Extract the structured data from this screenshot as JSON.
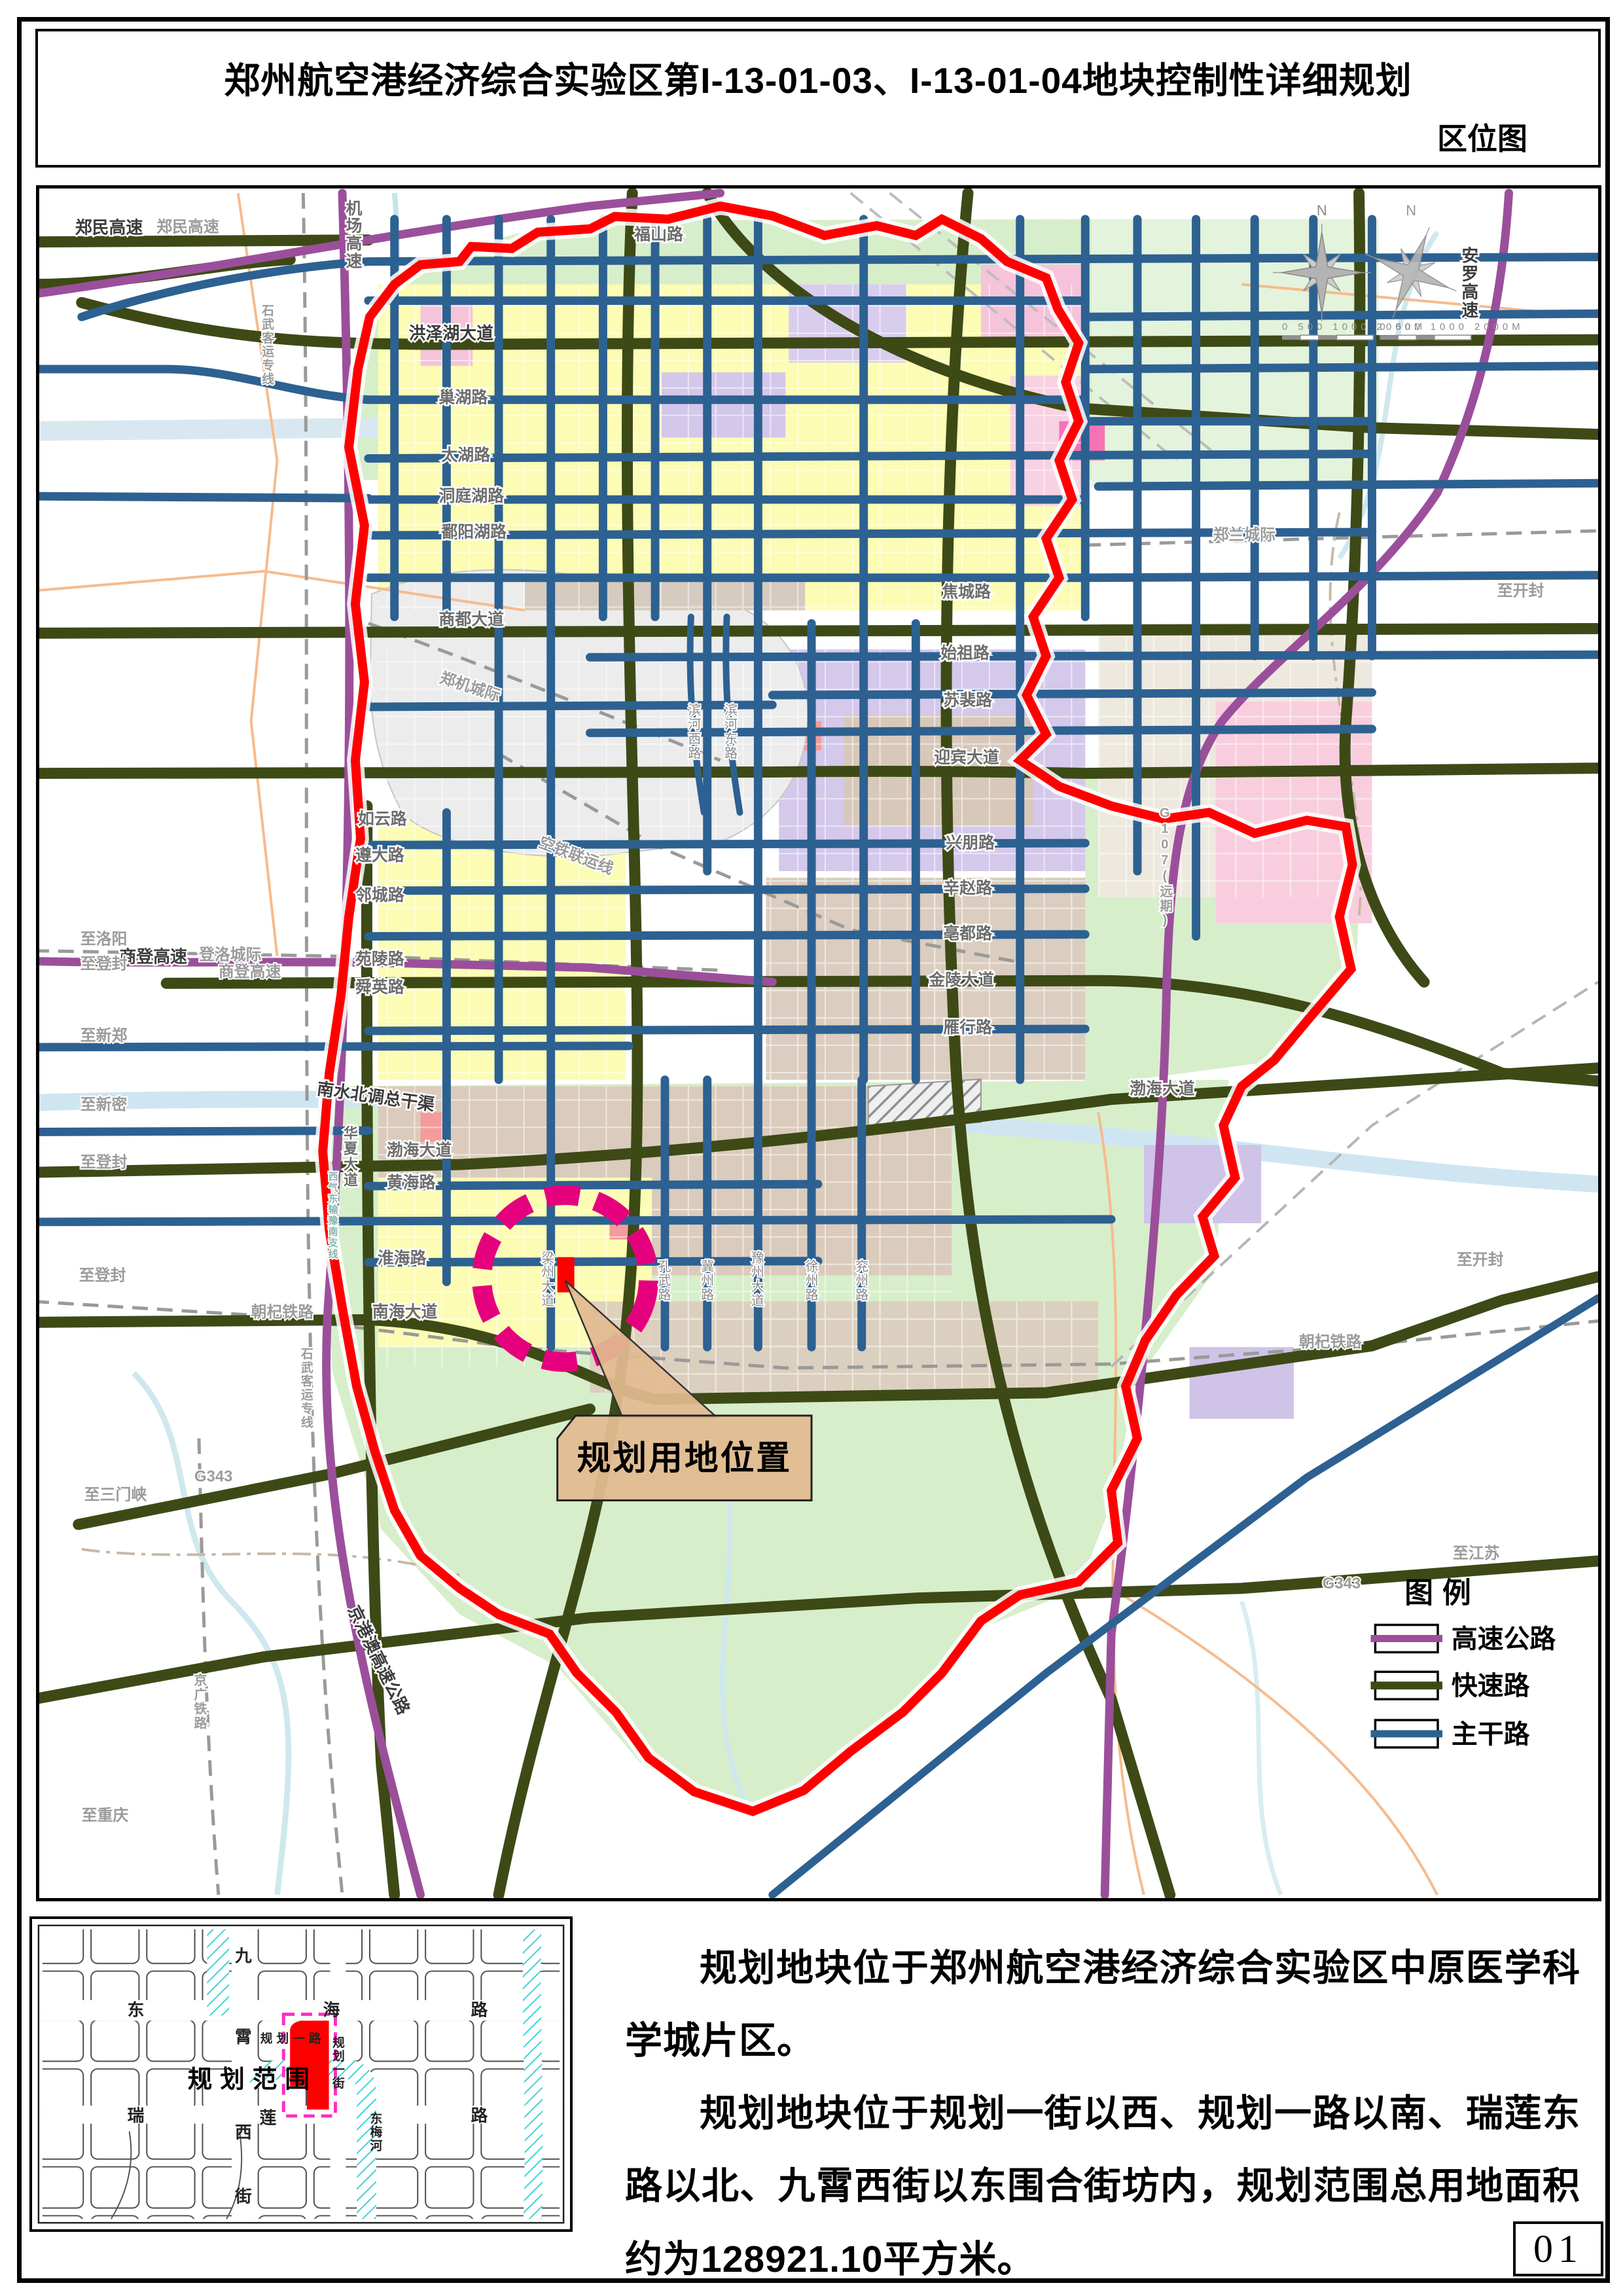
{
  "page": {
    "title": "郑州航空港经济综合实验区第I-13-01-03、I-13-01-04地块控制性详细规划",
    "subtitle": "区位图",
    "page_number": "01"
  },
  "description": {
    "para1": "规划地块位于郑州航空港经济综合实验区中原医学科学城片区。",
    "para2": "规划地块位于规划一街以西、规划一路以南、瑞莲东路以北、九霄西街以东围合街坊内，规划范围总用地面积约为128921.10平方米。"
  },
  "legend": {
    "title": "图例",
    "items": [
      {
        "name": "highway",
        "label": "高速公路",
        "color": "#9b4f9b"
      },
      {
        "name": "expressway",
        "label": "快速路",
        "color": "#3d4a16"
      },
      {
        "name": "arterial",
        "label": "主干路",
        "color": "#2d6191"
      }
    ]
  },
  "callout": {
    "label": "规划用地位置"
  },
  "compass": {
    "n": "N"
  },
  "scalebar": {
    "ticks": "0   500  1000        2000M"
  },
  "colors": {
    "boundary": "#ff0000",
    "site": "#ff0000",
    "site_circle": "#e5007e",
    "water": "#cfe6f2",
    "green_area": "#d7eecb"
  },
  "map": {
    "labels": {
      "zhengmin_dark": "郑民高速",
      "zhengmin_gray": "郑民高速",
      "jichang_gs": "机场高速",
      "fushan": "福山路",
      "anluo": "安罗高速",
      "hongzehu": "洪泽湖大道",
      "chaohu": "巢湖路",
      "taihu": "太湖路",
      "dongtinghu": "洞庭湖路",
      "poyanghu": "鄱阳湖路",
      "shangdu": "商都大道",
      "zhenglan": "郑兰城际",
      "shiwu_n": "石武客运专线",
      "jiaocheng": "焦城路",
      "shizu": "始祖路",
      "supei": "苏裴路",
      "yingbin": "迎宾大道",
      "binhe_w": "滨河西路",
      "binhe_e": "滨河东路",
      "zhengji": "郑机城际",
      "kongtie": "空铁联运线",
      "ruyun": "如云路",
      "zunda": "遵大路",
      "lincheng": "邻城路",
      "yuanling": "苑陵路",
      "shunying": "舜英路",
      "xingpeng": "兴朋路",
      "xinzhao": "辛赵路",
      "bodu": "亳都路",
      "jinling": "金陵大道",
      "yanxing": "雁行路",
      "g107": "G107(远期)",
      "nanshui": "南水北调总干渠",
      "bohai_w": "渤海大道",
      "bohai_e": "渤海大道",
      "huanghai": "黄海路",
      "huaihai": "淮海路",
      "nanhai": "南海大道",
      "huaxia": "华夏大道",
      "xiqi": "西气东输豫南支线",
      "liangzhou": "梁州大道",
      "kongwu": "孔武路",
      "jizhou": "冀州路",
      "yuzhou": "豫州大道",
      "xuzhou": "徐州路",
      "yanzhou": "兖州路",
      "to_luoyang": "至洛阳",
      "shangdeng_dark": "商登高速",
      "dengluo": "登洛城际",
      "shangdeng_gray": "商登高速",
      "to_dengfeng1": "至登封",
      "to_xinzheng": "至新郑",
      "to_xinmi": "至新密",
      "to_dengfeng2": "至登封",
      "to_dengfeng3": "至登封",
      "to_sanmenxia": "至三门峡",
      "g343_w": "G343",
      "chaoqi_w": "朝杞铁路",
      "jingguang": "京广铁路",
      "shiwu_s": "石武客运专线",
      "jinggangao": "京港澳高速公路",
      "to_chongqing": "至重庆",
      "to_kaifeng1": "至开封",
      "to_kaifeng2": "至开封",
      "chaoqi_e": "朝杞铁路",
      "to_jiangsu": "至江苏",
      "g343_e": "G343"
    }
  },
  "inset": {
    "labels": {
      "dong": "东",
      "hai": "海",
      "lu_a": "路",
      "jiu": "九",
      "xiao": "霄",
      "xi": "西",
      "jie": "街",
      "rui": "瑞",
      "lian": "莲",
      "lu_b": "路",
      "gh_lu": "规划一路",
      "gh_jie": "规划一街",
      "dongmeihe": "东梅河",
      "scope": "规划范围"
    }
  }
}
